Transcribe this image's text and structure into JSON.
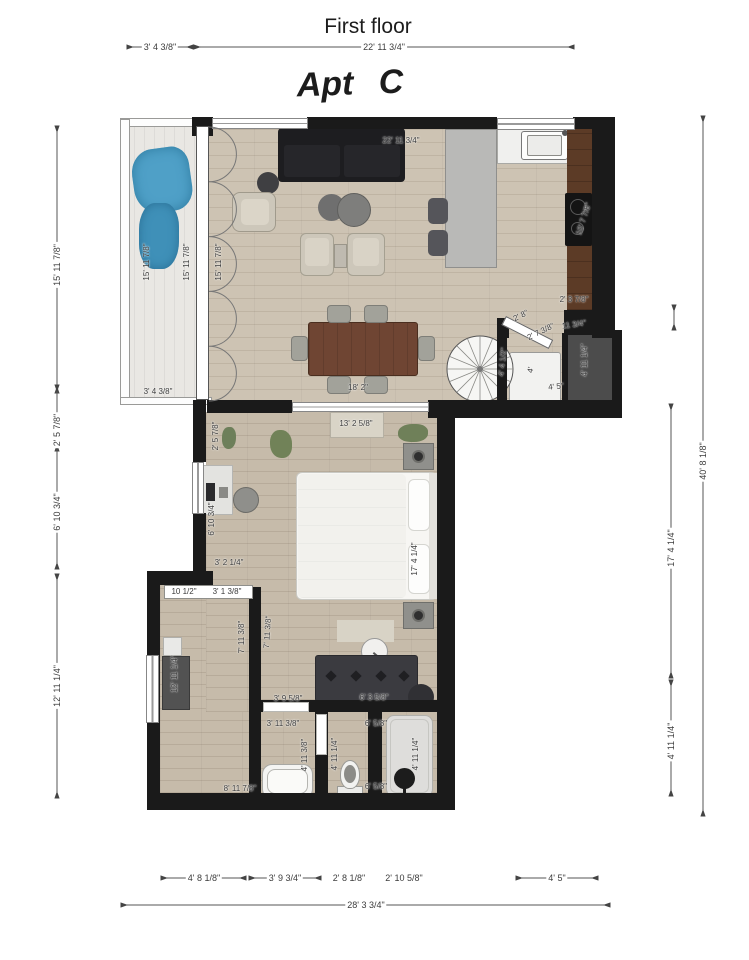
{
  "header": {
    "title": "First floor",
    "apartment_label": "Apt C"
  },
  "colors": {
    "wall": "#1a1a1a",
    "floor": "#cdc3b3",
    "floor2": "#c6bbaa",
    "balcony": "#e9e7e3",
    "counterwood": "#5c3b26",
    "tablewood": "#6f4533",
    "sofablack": "#1d1d20",
    "storage": "#4c4c4c",
    "beige": "#cdc7ba",
    "blue": "#4fa0c7",
    "dimtext": "#3c3c3c"
  },
  "dimensions": [
    {
      "t": "3' 4 3/8\"",
      "x": 160,
      "y": 47,
      "line": [
        133,
        47,
        187,
        47
      ]
    },
    {
      "t": "22' 11 3/4\"",
      "x": 384,
      "y": 47,
      "line": [
        200,
        47,
        568,
        47
      ]
    },
    {
      "t": "15' 11 7/8\"",
      "x": 57,
      "y": 265,
      "r": -90,
      "line": [
        57,
        132,
        57,
        387
      ]
    },
    {
      "t": "2' 5 7/8\"",
      "x": 57,
      "y": 430,
      "r": -90,
      "line": [
        57,
        391,
        57,
        445
      ]
    },
    {
      "t": "6' 10 3/4\"",
      "x": 57,
      "y": 512,
      "r": -90,
      "line": [
        57,
        447,
        57,
        563
      ]
    },
    {
      "t": "12' 11 1/4\"",
      "x": 57,
      "y": 686,
      "r": -90,
      "line": [
        57,
        580,
        57,
        792
      ]
    },
    {
      "t": "17' 4 1/4\"",
      "x": 671,
      "y": 548,
      "r": -90,
      "line": [
        671,
        410,
        671,
        672
      ]
    },
    {
      "t": "4' 11 1/4\"",
      "x": 671,
      "y": 741,
      "r": -90,
      "line": [
        671,
        686,
        671,
        790
      ]
    },
    {
      "t": "40' 8 1/8\"",
      "x": 703,
      "y": 461,
      "r": -90,
      "line": [
        703,
        122,
        703,
        810
      ]
    },
    {
      "line": [
        674,
        311,
        674,
        324
      ]
    },
    {
      "t": "4' 8 1/8\"",
      "x": 204,
      "y": 878,
      "line": [
        167,
        878,
        240,
        878
      ]
    },
    {
      "t": "3' 9 3/4\"",
      "x": 285,
      "y": 878,
      "line": [
        255,
        878,
        315,
        878
      ]
    },
    {
      "t": "2' 8 1/8\"",
      "x": 349,
      "y": 878
    },
    {
      "t": "2' 10 5/8\"",
      "x": 404,
      "y": 878
    },
    {
      "t": "4' 5\"",
      "x": 557,
      "y": 878,
      "line": [
        522,
        878,
        592,
        878
      ]
    },
    {
      "t": "28' 3 3/4\"",
      "x": 366,
      "y": 905,
      "line": [
        127,
        905,
        604,
        905
      ]
    },
    {
      "t": "3' 4 3/8\"",
      "x": 158,
      "y": 392,
      "bare": true
    },
    {
      "t": "15' 11 7/8\"",
      "x": 147,
      "y": 262,
      "r": -90,
      "bare": true
    },
    {
      "t": "15' 11 7/8\"",
      "x": 187,
      "y": 262,
      "r": -90,
      "bare": true
    },
    {
      "t": "15' 11 7/8\"",
      "x": 219,
      "y": 262,
      "r": -90,
      "bare": true
    },
    {
      "t": "22' 11 3/4\"",
      "x": 401,
      "y": 141,
      "bare": true
    },
    {
      "t": "10' 7 7/8\"",
      "x": 584,
      "y": 219,
      "r": -72,
      "bare": true
    },
    {
      "t": "2' 3 7/8\"",
      "x": 574,
      "y": 300,
      "bare": true
    },
    {
      "t": "2' 8\"",
      "x": 521,
      "y": 316,
      "r": -26,
      "bare": true
    },
    {
      "t": "2' 7 3/8\"",
      "x": 541,
      "y": 332,
      "r": -26,
      "bare": true
    },
    {
      "t": "11 3/4\"",
      "x": 574,
      "y": 325,
      "r": -8,
      "bare": true
    },
    {
      "t": "4' 4 1/2\"",
      "x": 503,
      "y": 362,
      "r": -84,
      "bare": true
    },
    {
      "t": "4'",
      "x": 531,
      "y": 370,
      "r": -80,
      "bare": true
    },
    {
      "t": "4' 5\"",
      "x": 556,
      "y": 387,
      "r": -6,
      "bare": true
    },
    {
      "t": "4' 11 1/4\"",
      "x": 585,
      "y": 360,
      "r": -90,
      "bare": true
    },
    {
      "t": "18' 2\"",
      "x": 358,
      "y": 388,
      "bare": true
    },
    {
      "t": "13' 2 5/8\"",
      "x": 356,
      "y": 424,
      "bare": true
    },
    {
      "t": "2' 5 7/8\"",
      "x": 216,
      "y": 436,
      "r": -90,
      "bare": true
    },
    {
      "t": "6' 10 3/4\"",
      "x": 212,
      "y": 519,
      "r": -90,
      "bare": true
    },
    {
      "t": "3' 2 1/4\"",
      "x": 229,
      "y": 563,
      "bare": true
    },
    {
      "t": "17' 4 1/4\"",
      "x": 415,
      "y": 559,
      "r": -90,
      "bare": true
    },
    {
      "t": "10 1/2\"",
      "x": 184,
      "y": 592,
      "bare": true
    },
    {
      "t": "3' 1 3/8\"",
      "x": 227,
      "y": 592,
      "bare": true
    },
    {
      "t": "12' 11 1/4\"",
      "x": 175,
      "y": 674,
      "r": -90,
      "bare": true
    },
    {
      "t": "7' 11 3/8\"",
      "x": 242,
      "y": 637,
      "r": -90,
      "bare": true
    },
    {
      "t": "7' 11 3/8\"",
      "x": 268,
      "y": 632,
      "r": -86,
      "bare": true
    },
    {
      "t": "3' 9 5/8\"",
      "x": 288,
      "y": 699,
      "bare": true
    },
    {
      "t": "3' 11 3/8\"",
      "x": 283,
      "y": 724,
      "bare": true
    },
    {
      "t": "6' 3 5/8\"",
      "x": 374,
      "y": 698,
      "bare": true
    },
    {
      "t": "4' 11 3/8\"",
      "x": 305,
      "y": 755,
      "r": -90,
      "bare": true
    },
    {
      "t": "4' 11 1/4\"",
      "x": 335,
      "y": 754,
      "r": -90,
      "bare": true
    },
    {
      "t": "6' 5/8\"",
      "x": 376,
      "y": 724,
      "bare": true
    },
    {
      "t": "4' 11 1/4\"",
      "x": 416,
      "y": 754,
      "r": -90,
      "bare": true
    },
    {
      "t": "6' 5/8\"",
      "x": 376,
      "y": 787,
      "bare": true
    },
    {
      "t": "8' 11 7/8\"",
      "x": 240,
      "y": 789,
      "bare": true
    }
  ]
}
